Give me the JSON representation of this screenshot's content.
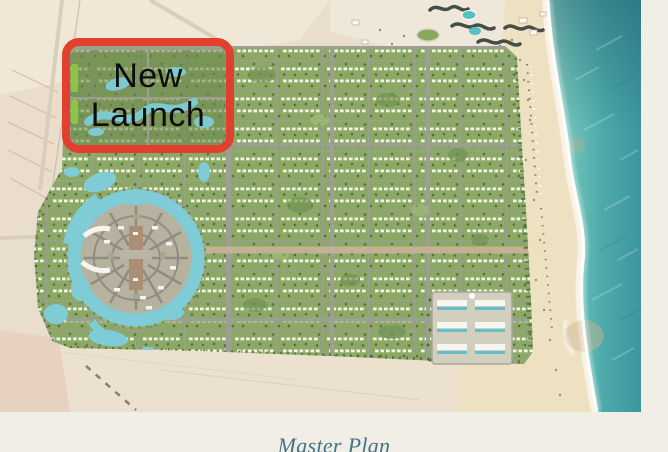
{
  "page": {
    "background_color": "#f1eee6"
  },
  "map": {
    "description": "aerial-master-plan-of-coastal-resort-development",
    "annotation": {
      "line1": "New",
      "line2": "Launch",
      "box_color": "#e2402f",
      "text_color": "#0d0d0d"
    },
    "caption": {
      "text": "Master Plan",
      "color": "#477184"
    },
    "palette": {
      "desert": "#e9ddcb",
      "beach": "#eee1c2",
      "sea_deep": "#3d95a0",
      "sea_shallow": "#9ad8ca",
      "greenery": "#8ba964",
      "trees": "#53703d",
      "roads": "#9d9f93",
      "lagoon": "#7fcbd6",
      "buildings": "#f3f3ea"
    }
  }
}
